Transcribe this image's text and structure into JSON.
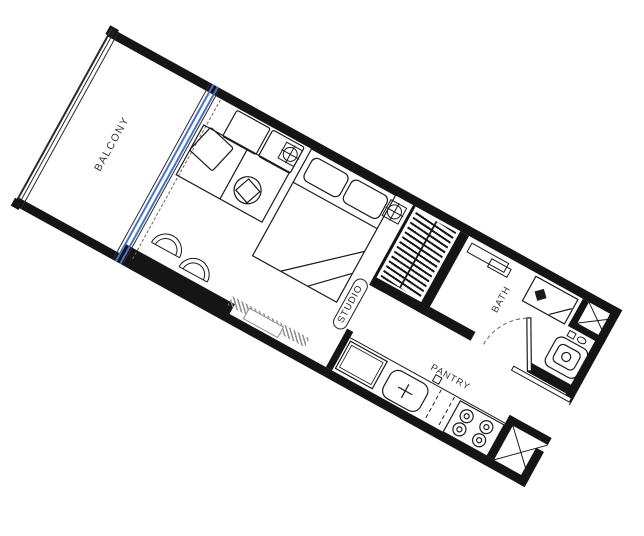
{
  "floorplan": {
    "rotation_deg": 28.9,
    "labels": {
      "balcony": "BALCONY",
      "studio": "STUDIO",
      "bath": "BATH",
      "pantry": "PANTRY"
    },
    "colors": {
      "walls": "#151515",
      "lines": "#1a1a1a",
      "sliding_door": "#4a72c8",
      "tv_console_hatch": "#8f8f8f",
      "background": "#ffffff"
    },
    "rooms": [
      {
        "name": "balcony",
        "label": "BALCONY"
      },
      {
        "name": "studio",
        "label": "STUDIO"
      },
      {
        "name": "bath",
        "label": "BATH"
      },
      {
        "name": "pantry",
        "label": "PANTRY"
      }
    ],
    "fixtures": [
      "balcony-railing",
      "sliding-glass-door",
      "curtain-track",
      "l-sofa",
      "sofa-cushion",
      "side-table",
      "double-bed",
      "bed-pillow",
      "ceiling-fan",
      "wardrobe",
      "tv-console",
      "stool",
      "bathroom-shelf",
      "shower",
      "toilet",
      "service-shaft",
      "bath-door",
      "entry-door",
      "kitchen-counter",
      "refrigerator",
      "kitchen-sink",
      "cooktop"
    ]
  }
}
